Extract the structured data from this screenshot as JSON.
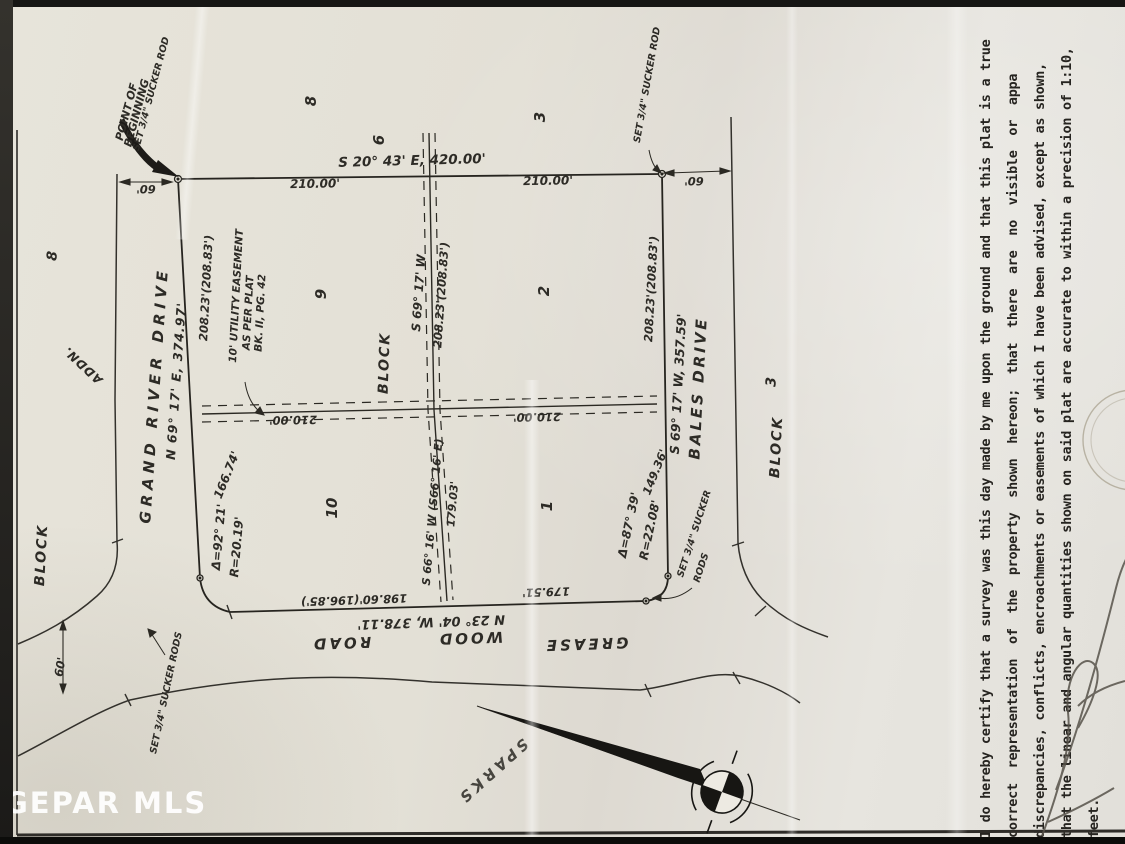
{
  "watermark": "GEPAR MLS",
  "pob": {
    "line1": "POINT OF",
    "line2": "BEGINNING",
    "rod": "SET 3/4\" SUCKER ROD"
  },
  "north_line": {
    "bearing": "S 20° 43' E, 420.00'",
    "seg_left": "210.00'",
    "seg_right": "210.00'",
    "width_dim_left": "60'",
    "width_dim_right": "60'",
    "rod_right": "SET 3/4\" SUCKER ROD"
  },
  "adjacent": {
    "lot8_top": "8",
    "lot6_top": "6",
    "lot3_top": "3",
    "lot8_left": "8",
    "addn": "ADDN.",
    "block_left": "BLOCK",
    "block_right": "BLOCK",
    "block_right_num": "3"
  },
  "streets": {
    "grand_river": {
      "name": "GRAND RIVER DRIVE",
      "bearing": "N 69° 17' E, 374.97'"
    },
    "bales": {
      "name": "BALES DRIVE",
      "bearing": "S 69° 17' W, 357.59'"
    },
    "greasewood": {
      "word1": "GREASE",
      "word2": "WOOD",
      "word3": "ROAD",
      "bearing": "N 23° 04' W, 378.11'",
      "seg_left": "198.60'(196.85')",
      "seg_right": "179.51'",
      "side_width_dim": "60'"
    }
  },
  "block": {
    "label": "BLOCK",
    "lots": {
      "lot9": "9",
      "lot2": "2",
      "lot10": "10",
      "lot1": "1"
    }
  },
  "interior": {
    "west_dist": "208.23'(208.83')",
    "center_bearing": "S 69° 17' W",
    "center_dist": "208.23'(208.83')",
    "east_dist": "208.23'(208.83')",
    "mid_seg_left": "210.00'",
    "mid_seg_right": "210.00'",
    "lower_bearing": "S 66° 16' W (S66° 16' E)",
    "lower_dist": "179.03'"
  },
  "easement_note": {
    "line1": "10' UTILITY EASEMENT",
    "line2": "AS PER PLAT",
    "line3": "BK. II, PG. 42"
  },
  "curves": {
    "southwest": {
      "delta": "Δ=92° 21'",
      "arc": "166.74'",
      "radius": "R=20.19'"
    },
    "southeast": {
      "delta": "Δ=87° 39'",
      "radius": "R=22.08'",
      "seg": "149.36'"
    }
  },
  "monuments": {
    "left": "SET 3/4\" SUCKER RODS",
    "southeast_line1": "SET 3/4\" SUCKER",
    "southeast_line2": "RODS"
  },
  "sparks": "SPARKS",
  "certification": {
    "line1": "I do hereby certify that a survey was this day made by me upon the ground and that this plat is a true",
    "line2": "correct representation of the property shown hereon; that there are no visible or appa",
    "line3": "discrepancies, conflicts, encroachments or easements of which I have been advised, except as shown,",
    "line4": "that the linear and angular quantities shown on said plat are accurate to within a precision of 1:10,",
    "line5": "feet."
  }
}
